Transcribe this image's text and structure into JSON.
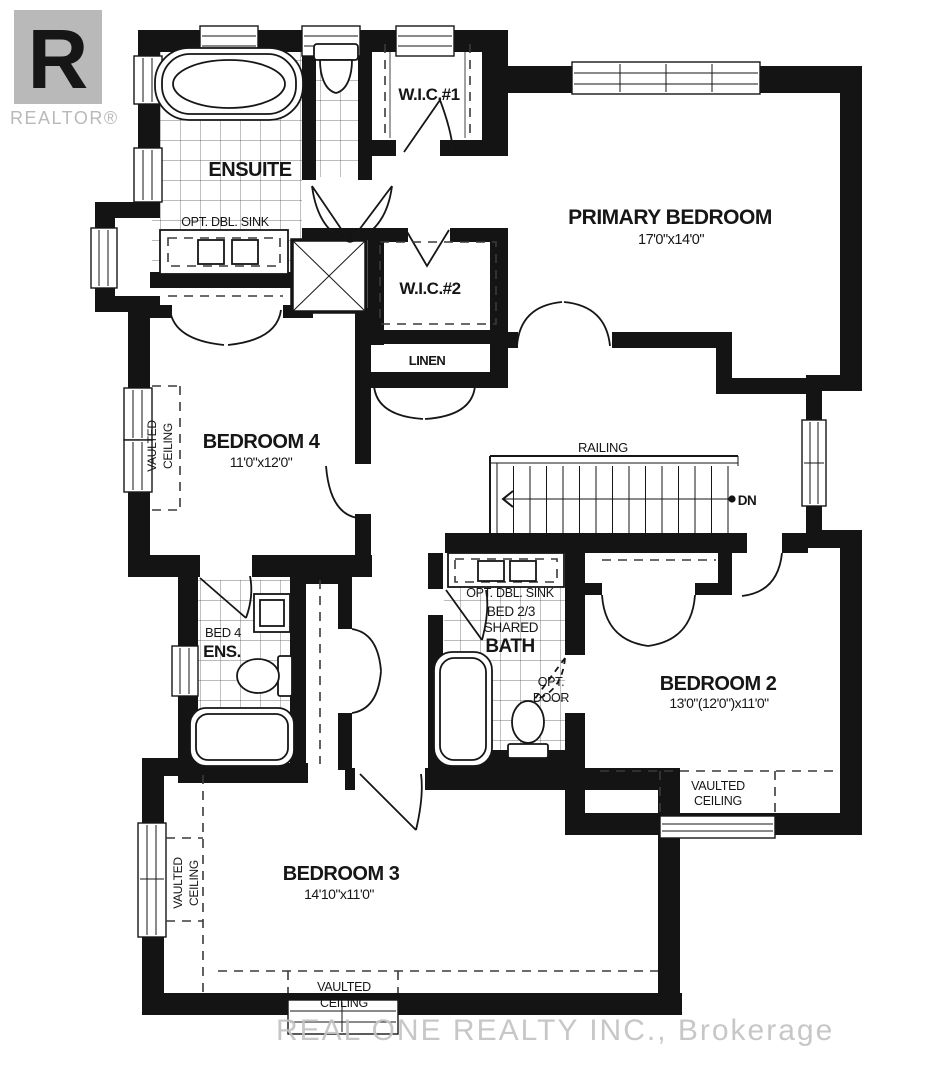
{
  "logo": {
    "letter": "R",
    "wordmark": "REALTOR®"
  },
  "watermark": "REAL ONE REALTY INC., Brokerage",
  "colors": {
    "wall": "#141414",
    "logo_gray": "#b9b9b9",
    "watermark_gray": "#c3c3c3"
  },
  "rooms": {
    "ensuite": {
      "name": "ENSUITE",
      "note": "OPT. DBL. SINK"
    },
    "wic1": {
      "name": "W.I.C.#1"
    },
    "wic2": {
      "name": "W.I.C.#2"
    },
    "linen": {
      "name": "LINEN"
    },
    "primary_bedroom": {
      "name": "PRIMARY BEDROOM",
      "dims": "17'0\"x14'0\""
    },
    "bedroom4": {
      "name": "BEDROOM 4",
      "dims": "11'0\"x12'0\"",
      "vaulted_line1": "VAULTED",
      "vaulted_line2": "CEILING"
    },
    "bed4_ensuite": {
      "name_line1": "BED 4",
      "name_line2": "ENS."
    },
    "shared_bath": {
      "note_sink": "OPT. DBL. SINK",
      "name_line1": "BED 2/3",
      "name_line2": "SHARED",
      "name_line3": "BATH",
      "note_door_line1": "OPT.",
      "note_door_line2": "DOOR"
    },
    "bedroom2": {
      "name": "BEDROOM 2",
      "dims": "13'0\"(12'0\")x11'0\"",
      "vaulted_line1": "VAULTED",
      "vaulted_line2": "CEILING"
    },
    "bedroom3": {
      "name": "BEDROOM 3",
      "dims": "14'10\"x11'0\"",
      "vaulted_line1": "VAULTED",
      "vaulted_line2": "CEILING",
      "vaulted_left_line1": "VAULTED",
      "vaulted_left_line2": "CEILING"
    },
    "stairs": {
      "railing": "RAILING",
      "direction": "DN"
    }
  }
}
